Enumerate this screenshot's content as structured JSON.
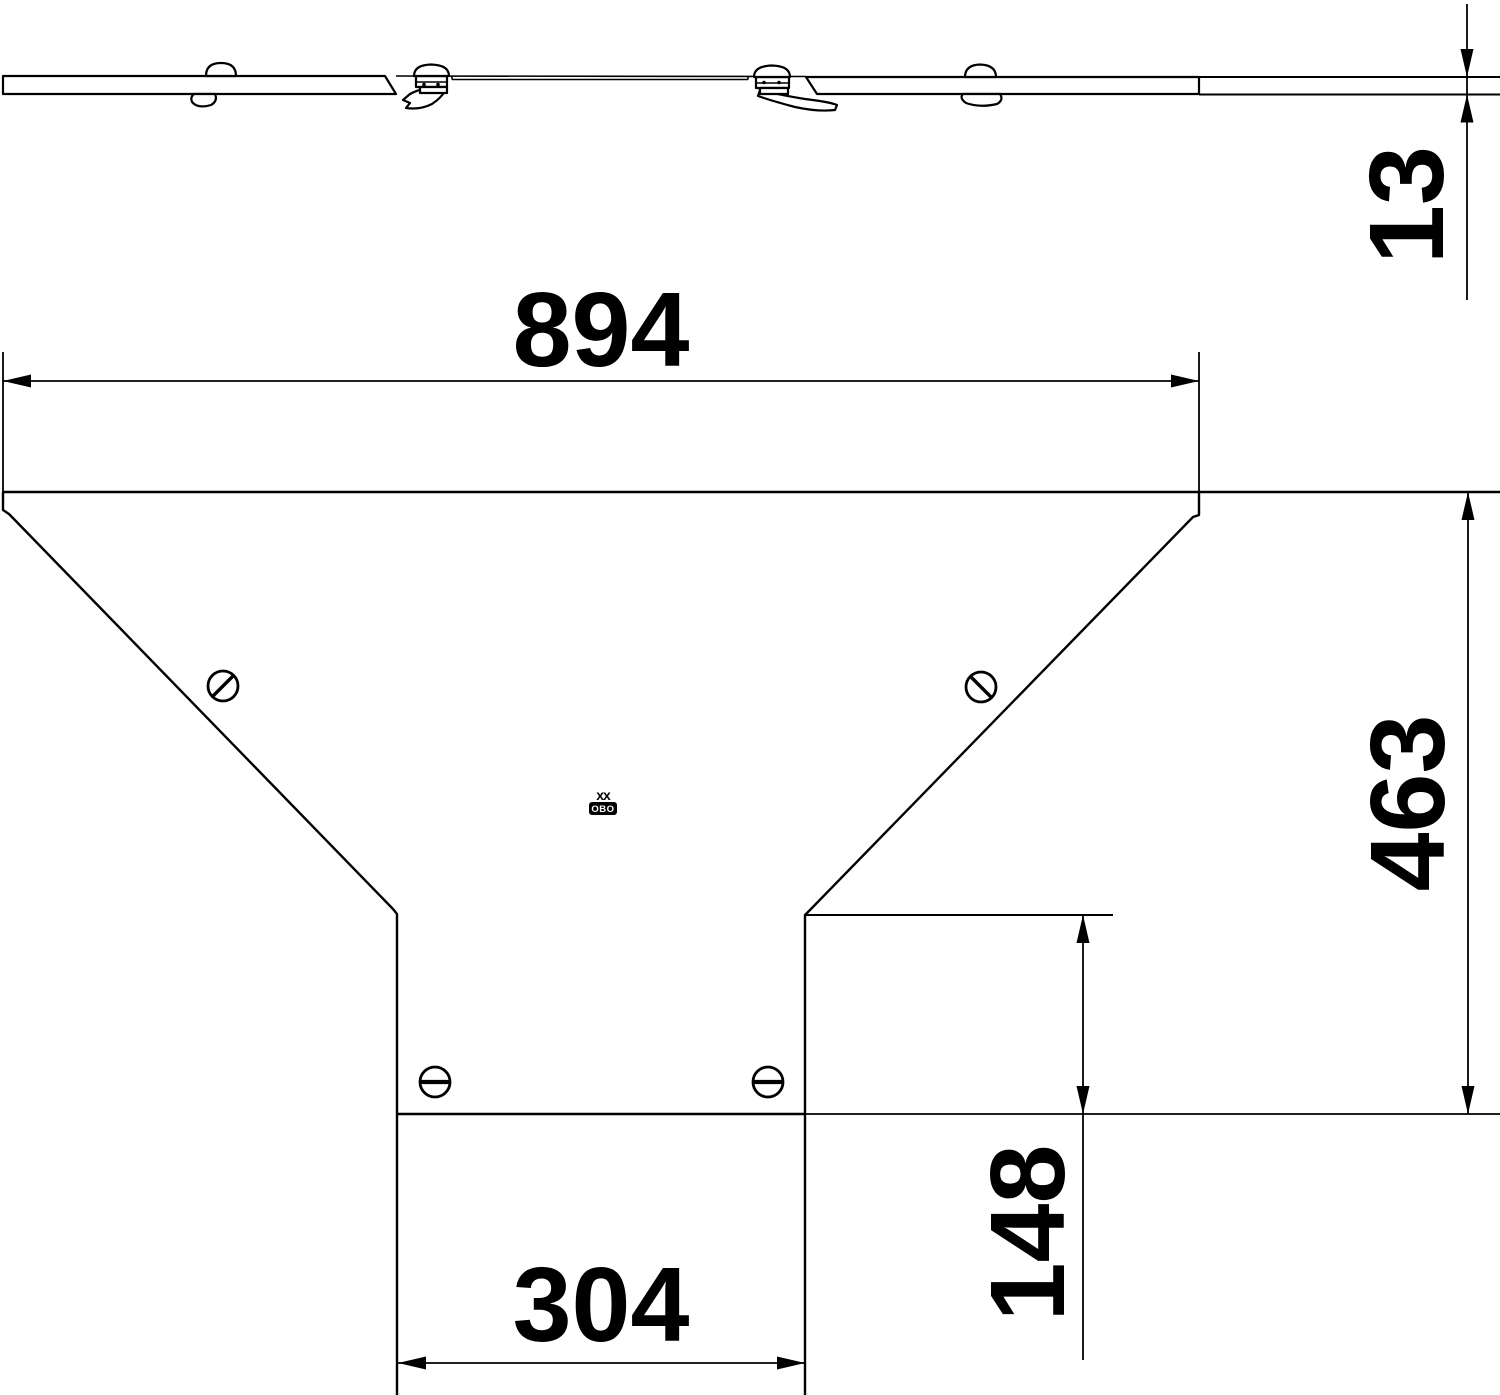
{
  "dimensions": {
    "overall_width": "894",
    "cover_thickness": "13",
    "overall_depth": "463",
    "branch_depth": "148",
    "branch_width": "304"
  },
  "stamp": {
    "marking": "xx",
    "logo": "OBO"
  },
  "colors": {
    "line": "#000000",
    "background": "#ffffff"
  }
}
